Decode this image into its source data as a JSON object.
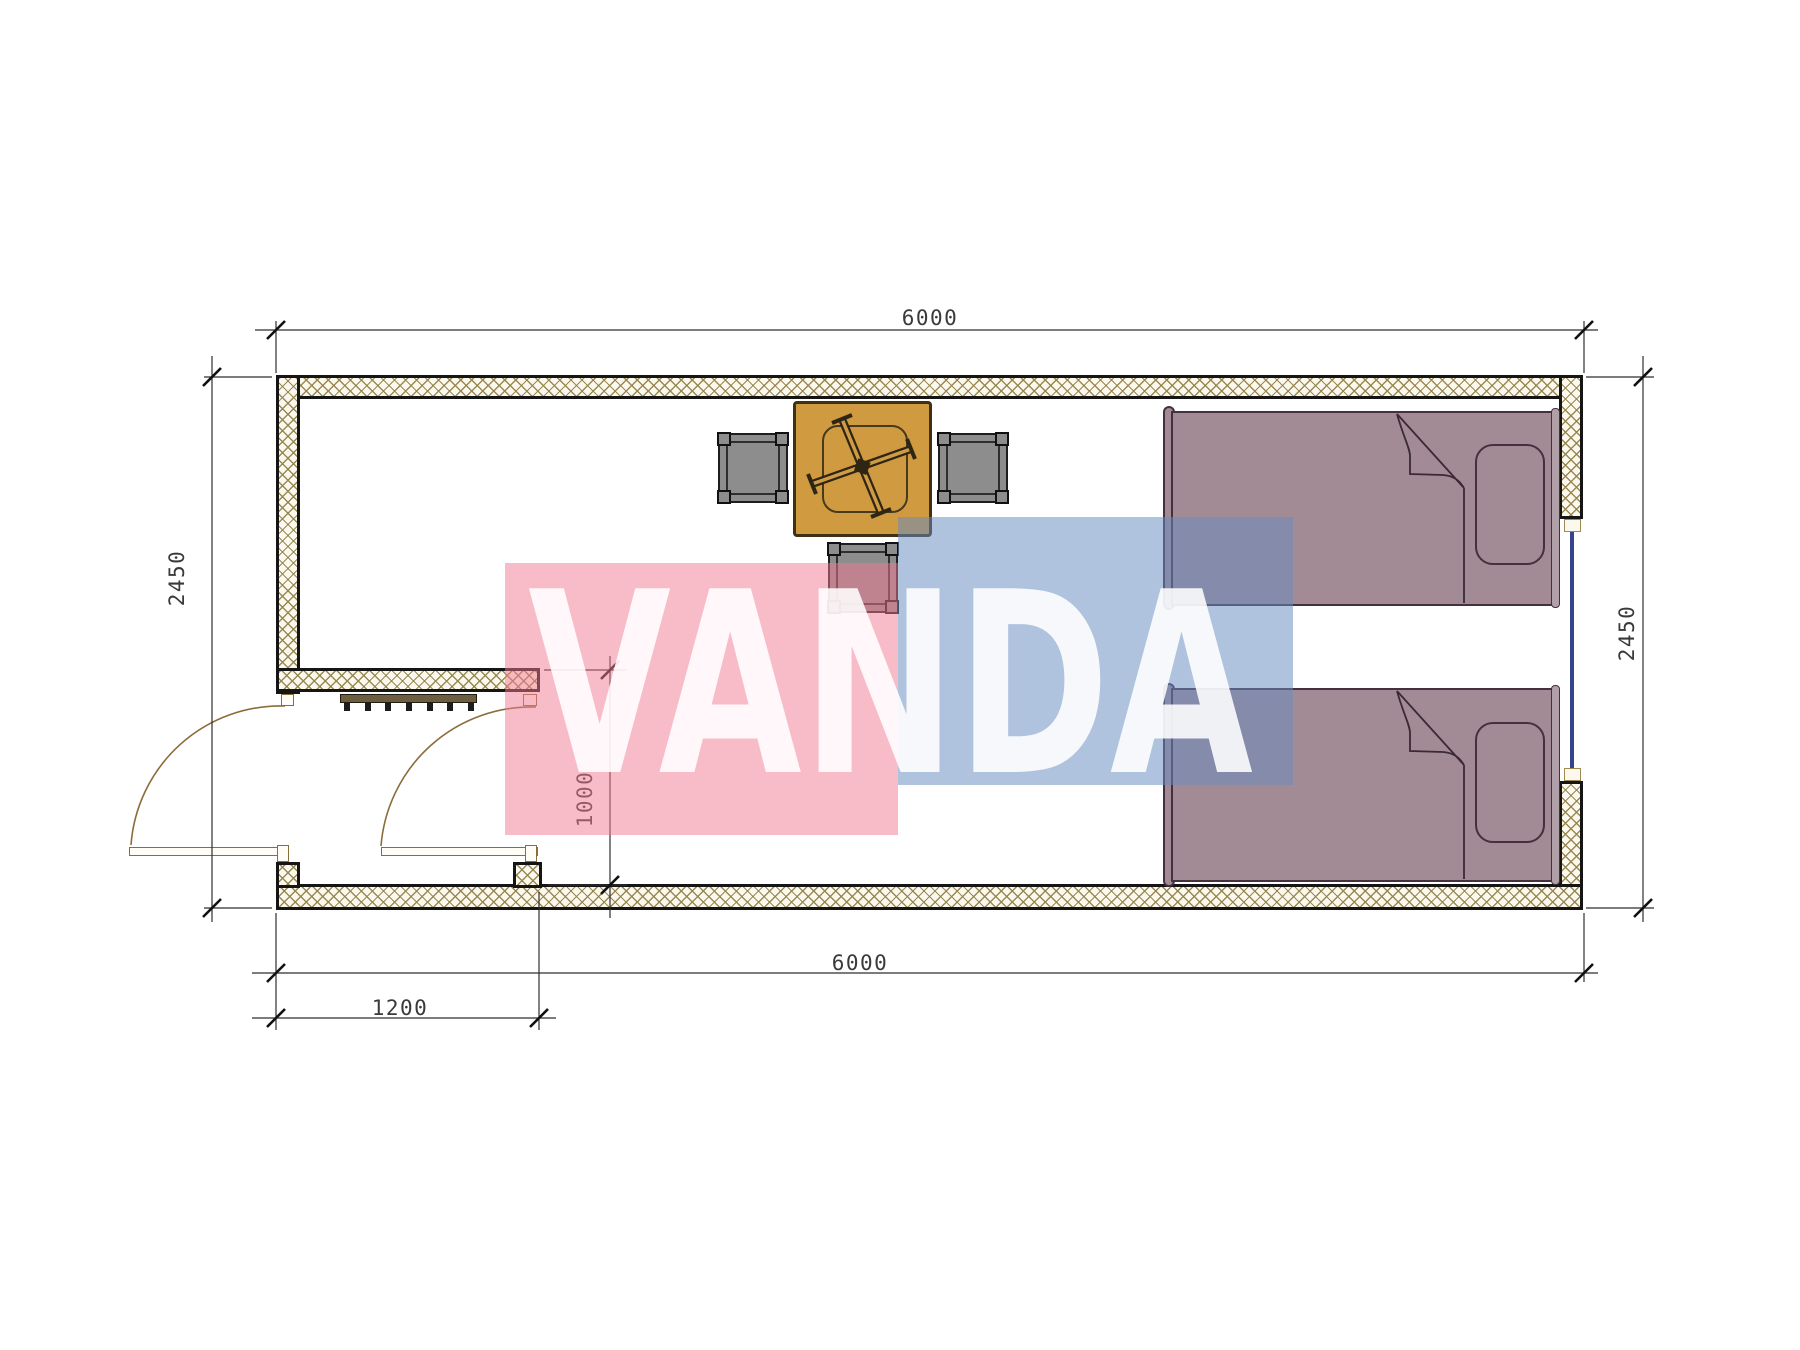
{
  "watermark": {
    "text": "VANDA",
    "pink_color": "#f27a92",
    "blue_color": "#688cc0",
    "text_color": "#ffffff"
  },
  "dimensions": {
    "top_width_mm": "6000",
    "bottom_width_mm": "6000",
    "left_height_mm": "2450",
    "right_height_mm": "2450",
    "entry_porch_width_mm": "1200",
    "passage_width_mm": "1000"
  },
  "plan": {
    "type": "container-cabin-floor-plan",
    "colors": {
      "wall_hatch_line": "#96834c",
      "wall_fill": "#fbf8ee",
      "wall_edge": "#151515",
      "table_fill": "#d09a40",
      "stool_fill": "#8d8d8d",
      "bed_fill": "#a38b95",
      "bed_outline": "#44303f",
      "door_swing_line": "#8a6d3a",
      "window_glass": "#36448f",
      "dimension_line": "#2f2f2f"
    },
    "furniture": [
      "folding-table",
      "stool",
      "stool",
      "stool",
      "single-bed",
      "single-bed",
      "radiator"
    ],
    "openings": [
      "entry-door",
      "interior-door",
      "window"
    ]
  }
}
